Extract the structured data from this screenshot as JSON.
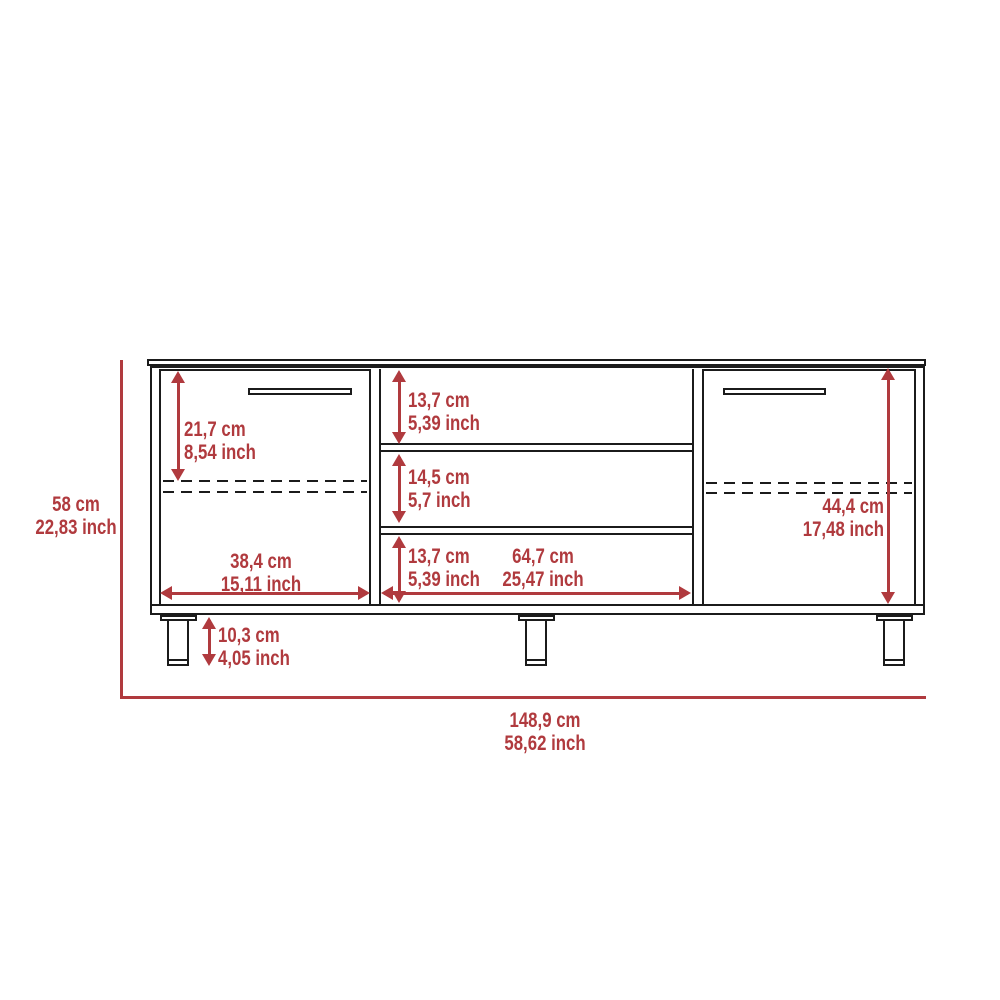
{
  "diagram": {
    "kind": "tv-stand-dimension-drawing",
    "accent_color": "#b03a3e",
    "line_color": "#1b1b1b",
    "background_color": "#ffffff"
  },
  "dims": {
    "overall_height": {
      "cm": "58 cm",
      "inch": "22,83 inch"
    },
    "overall_width": {
      "cm": "148,9 cm",
      "inch": "58,62 inch"
    },
    "left_door_height": {
      "cm": "21,7 cm",
      "inch": "8,54 inch"
    },
    "left_door_width": {
      "cm": "38,4 cm",
      "inch": "15,11 inch"
    },
    "top_compartment_height": {
      "cm": "13,7 cm",
      "inch": "5,39 inch"
    },
    "middle_compartment_height": {
      "cm": "14,5 cm",
      "inch": "5,7 inch"
    },
    "bottom_compartment_height": {
      "cm": "13,7 cm",
      "inch": "5,39 inch"
    },
    "center_section_width": {
      "cm": "64,7 cm",
      "inch": "25,47 inch"
    },
    "right_door_height": {
      "cm": "44,4 cm",
      "inch": "17,48 inch"
    },
    "leg_height": {
      "cm": "10,3 cm",
      "inch": "4,05 inch"
    }
  }
}
